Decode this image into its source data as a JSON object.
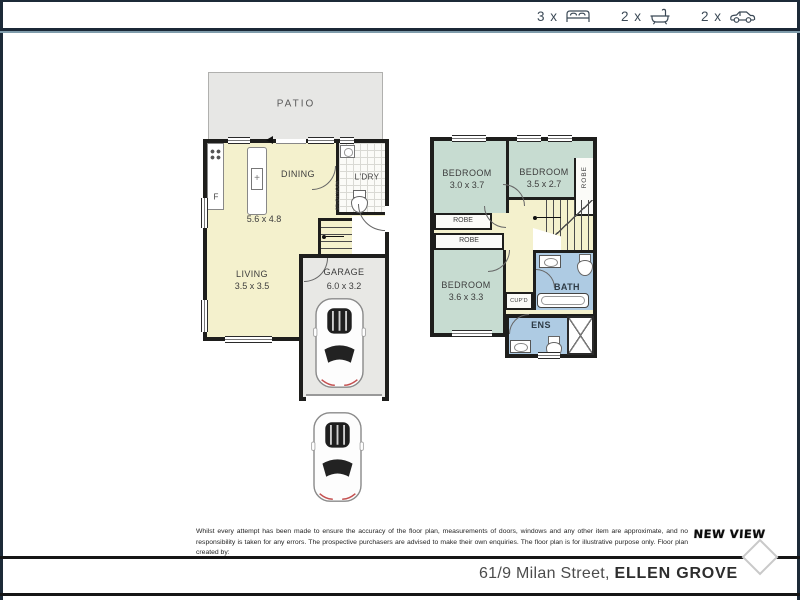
{
  "header": {
    "bed_count": "3 x",
    "bath_count": "2 x",
    "car_count": "2 x"
  },
  "ground_floor": {
    "patio_label": "PATIO",
    "dining_label": "DINING",
    "laundry_label": "L'DRY",
    "study_nook_label": "STUDY NOOK",
    "fridge_label": "F",
    "living_dining_dims": "5.6 x 4.8",
    "living_label": "LIVING",
    "living_dims": "3.5 x 3.5",
    "garage_label": "GARAGE",
    "garage_dims": "6.0 x 3.2"
  },
  "upper_floor": {
    "bedroom1_label": "BEDROOM",
    "bedroom1_dims": "3.0 x 3.7",
    "bedroom2_label": "BEDROOM",
    "bedroom2_dims": "3.5 x 2.7",
    "bedroom3_label": "BEDROOM",
    "bedroom3_dims": "3.6 x 3.3",
    "robe1_label": "ROBE",
    "robe2_label": "ROBE",
    "robe3_label": "ROBE",
    "bath_label": "BATH",
    "ens_label": "ENS",
    "cupboard_label": "CUP'D"
  },
  "disclaimer": "Whilst every attempt has been made to ensure the accuracy of the floor plan, measurements of doors, windows and any other item are approximate, and no responsibility is taken for any errors. The prospective purchasers are advised to make their own enquiries. The floor plan is for illustrative purpose only. Floor plan created by:",
  "logo_text": "NEW VIEW",
  "footer": {
    "address_street": "61/9 Milan Street, ",
    "address_suburb": "ELLEN GROVE"
  },
  "colors": {
    "navy": "#1c2a38",
    "separator_accent": "#7f9cab",
    "wall": "#1e1e1c",
    "floor_yellow": "#f4f1cd",
    "bedroom_green": "#c7dcd1",
    "wet_area_blue": "#aecbe3",
    "patio_gray": "#e7e7e5",
    "garage_gray": "#e8e8e5"
  }
}
